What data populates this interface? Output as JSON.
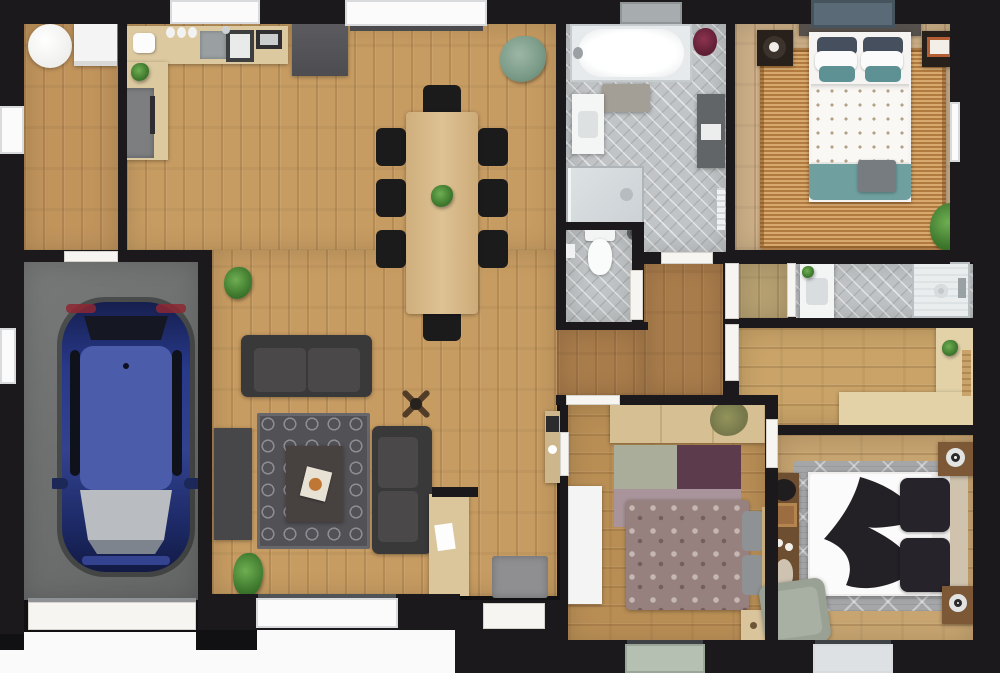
{
  "meta": {
    "title": "house-floor-plan-top-view",
    "style": "3d-rendered top-down architectural floor plan",
    "text_labels": []
  },
  "palette": {
    "outside": "#111113",
    "wall": "#1b191b",
    "wood_main": "#c79c62",
    "wood_pale": "#cdb088",
    "wood_hall": "#a97c4b",
    "wood_bc": "#b98e55",
    "wood_br": "#c7a470",
    "wood_office": "#c9a368",
    "wood_closet": "#b7a172",
    "garage_floor": "#6f7271",
    "tile_gray": "#c1c4c6",
    "counter_tan": "#dcc9a0",
    "fridge_gray": "#56565a",
    "sofa_dark": "#434243",
    "chair_black": "#1c1b1c",
    "table_wood": "#d7ba8a",
    "car_blue": "#2c3a8e",
    "teal_bedding": "#6f9f9e",
    "jute_rug": "#c48c4e",
    "damask_mauve": "#97817f",
    "rug_sage": "#a9ad9a",
    "rug_plum": "#5c3c4c",
    "rug_mauve": "#a8949a",
    "armchair_sage": "#99a194",
    "window_blue": "#5a6b77",
    "window_sage": "#b5c0b2"
  },
  "rooms": [
    {
      "name": "laundry-room",
      "items": [
        "round-table",
        "washing-machine"
      ]
    },
    {
      "name": "garage",
      "items": [
        "blue-car",
        "garage-door",
        "side-window"
      ]
    },
    {
      "name": "kitchen",
      "items": [
        "l-shaped-counter",
        "range",
        "sink",
        "coffee-maker",
        "jars",
        "toaster",
        "plant",
        "refrigerator"
      ]
    },
    {
      "name": "dining-area",
      "items": [
        "wood-table",
        "eight-black-chairs",
        "table-plant",
        "corner-plant"
      ]
    },
    {
      "name": "living-area",
      "items": [
        "sofa",
        "chaise-sofa",
        "trellis-rug",
        "coffee-table",
        "book",
        "tv-cabinet",
        "ceiling-fan",
        "floor-plant",
        "doormat",
        "entry-desk",
        "hall-console"
      ]
    },
    {
      "name": "main-bathroom",
      "items": [
        "bathtub",
        "vanity-sink",
        "walk-in-shower",
        "bath-rug",
        "tall-cabinet",
        "red-plant",
        "radiator"
      ]
    },
    {
      "name": "wc",
      "items": [
        "toilet",
        "waste-bin",
        "toilet-paper-holder"
      ]
    },
    {
      "name": "shower-room",
      "items": [
        "vanity-sink",
        "shower"
      ]
    },
    {
      "name": "office-nook",
      "items": [
        "l-shaped-desk",
        "desk-plant"
      ]
    },
    {
      "name": "bedroom-top-right",
      "items": [
        "double-bed",
        "teal-and-white-bedding",
        "jute-rug",
        "nightstand-left",
        "nightstand-right",
        "plant"
      ]
    },
    {
      "name": "bedroom-bottom-center",
      "items": [
        "double-bed-floral",
        "wood-wardrobe",
        "white-wardrobe",
        "patch-rug",
        "nightstand"
      ]
    },
    {
      "name": "bedroom-bottom-right",
      "items": [
        "double-bed-black-white",
        "diamond-rug",
        "nightstand-top",
        "nightstand-bottom",
        "wall-console",
        "sage-armchair"
      ]
    }
  ],
  "openings": {
    "windows": 10,
    "doors": 11,
    "garage_door": 1,
    "entry_door": 1
  }
}
